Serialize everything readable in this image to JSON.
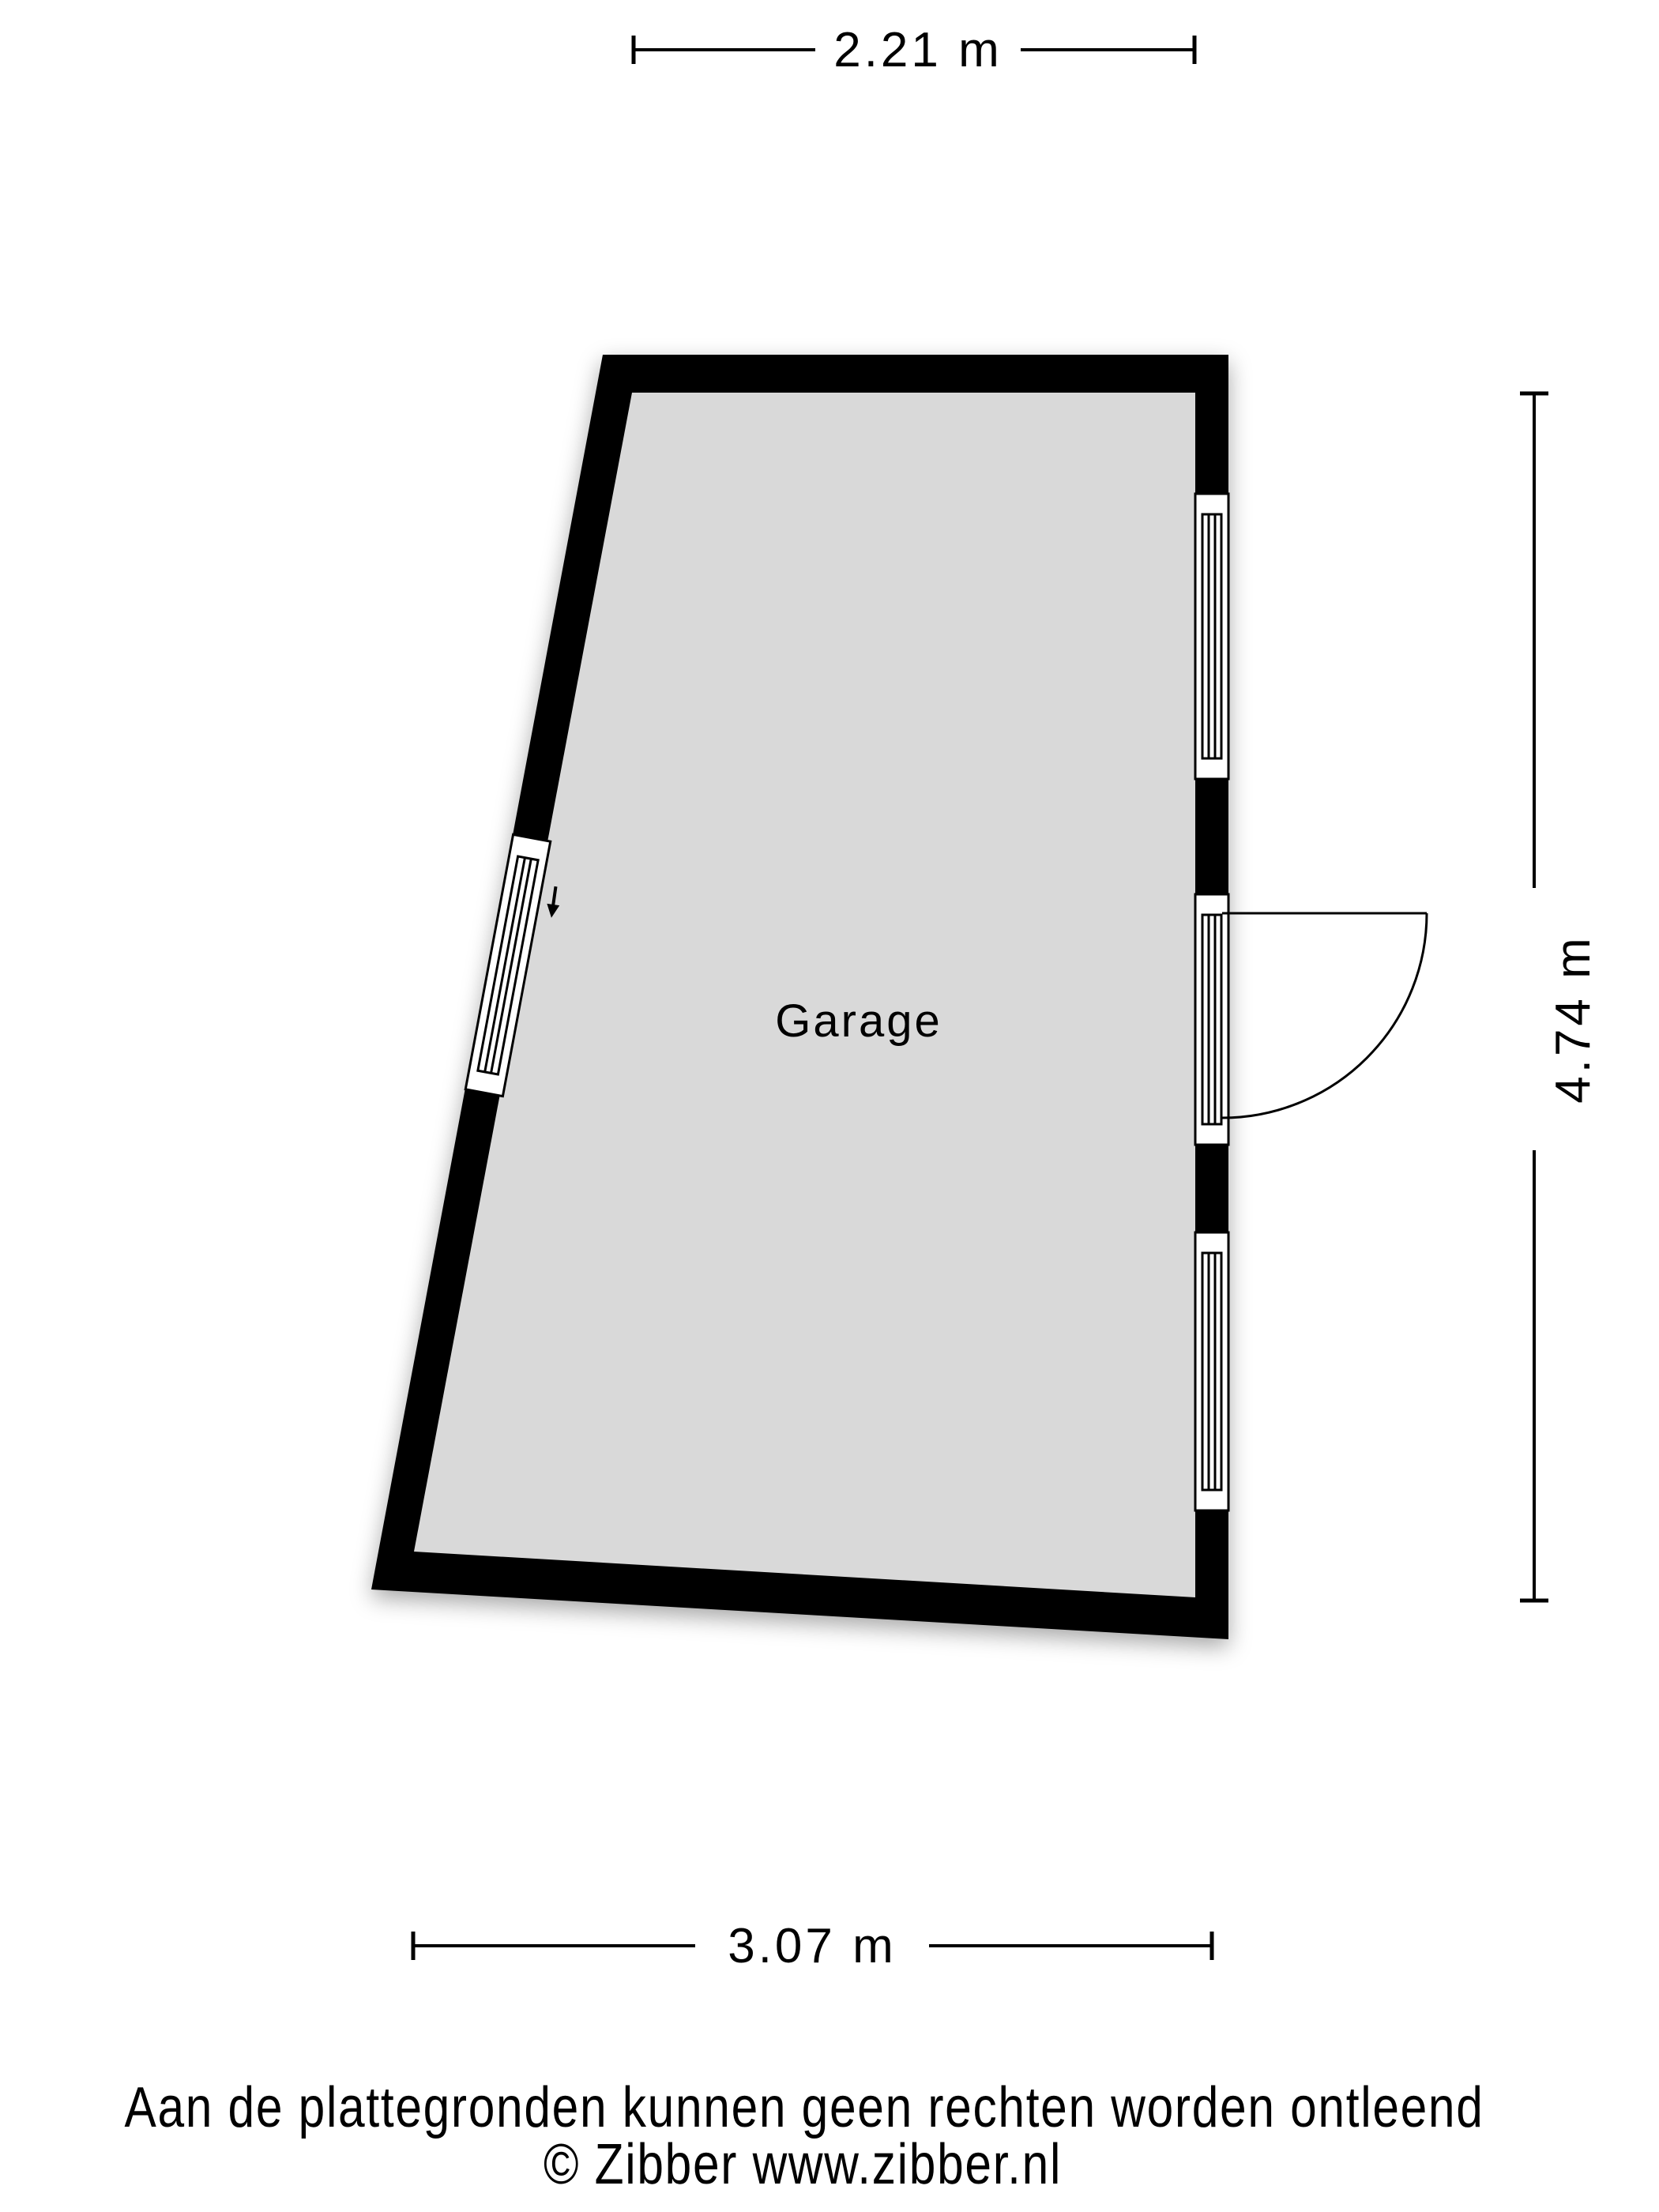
{
  "document": {
    "type": "floor-plan",
    "provider": "Zibber"
  },
  "room": {
    "label": "Garage"
  },
  "dimensions": {
    "top_width": "2.21 m",
    "right_height": "4.74 m",
    "bottom_width": "3.07 m"
  },
  "features": {
    "left_wall": [
      "window"
    ],
    "right_wall": [
      "window",
      "door-with-swing-arc",
      "window"
    ],
    "entrance_arrow": "down"
  },
  "footer": {
    "disclaimer": "Aan de plattegronden kunnen geen rechten worden ontleend",
    "copyright": "© Zibber www.zibber.nl"
  },
  "colors": {
    "wall": "#000000",
    "floor": "#d9d9d9",
    "background": "#ffffff"
  }
}
